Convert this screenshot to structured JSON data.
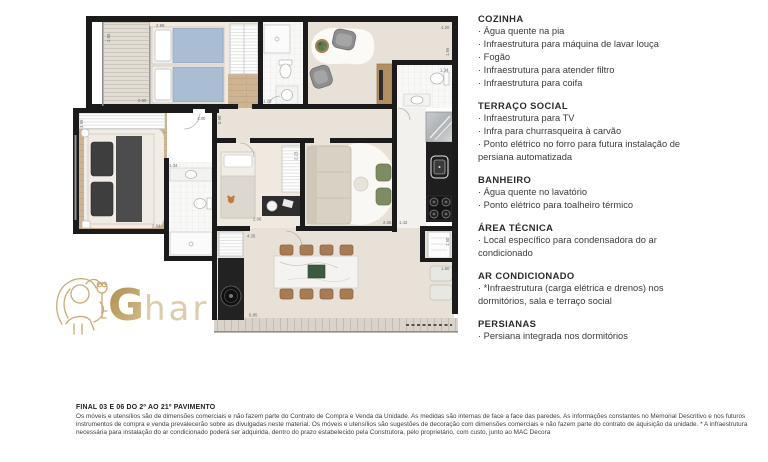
{
  "logo": {
    "initial": "G",
    "rest": "har"
  },
  "floorplan": {
    "dimensions": [
      "2.95",
      "2.99",
      "0.90",
      "4.00",
      "1.29",
      "4.20",
      "1.55",
      "1.34",
      "3.95",
      "1.34",
      "2.64",
      "2.23",
      "2.06",
      "4.35",
      "2.56",
      "1.42",
      "1.50",
      "1.80",
      "6.85",
      "0.90"
    ]
  },
  "specs": {
    "sections": [
      {
        "title": "COZINHA",
        "items": [
          "· Água quente na pia",
          "· Infraestrutura para máquina de lavar louça",
          "· Fogão",
          "· Infraestrutura para atender filtro",
          "· Infraestrutura para coifa"
        ]
      },
      {
        "title": "TERRAÇO SOCIAL",
        "items": [
          "· Infraestrutura para TV",
          "· Infra para churrasqueira à carvão",
          "· Ponto elétrico no forro para futura instalação de persiana automatizada"
        ]
      },
      {
        "title": "BANHEIRO",
        "items": [
          "· Água quente no lavatório",
          "· Ponto elétrico para toalheiro térmico"
        ]
      },
      {
        "title": "ÁREA TÉCNICA",
        "items": [
          "· Local específico para condensadora do ar condicionado"
        ]
      },
      {
        "title": "AR CONDICIONADO",
        "items": [
          "· *Infraestrutura (carga elétrica e drenos) nos dormitórios, sala e terraço social"
        ]
      },
      {
        "title": "PERSIANAS",
        "items": [
          "· Persiana integrada nos dormitórios"
        ]
      }
    ]
  },
  "footer": {
    "title": "FINAL 03 E 06 DO 2º AO 21º PAVIMENTO",
    "body": "Os móveis e utensílios são de dimensões comerciais e não fazem parte do Contrato de Compra e Venda da Unidade. As medidas são internas de face a face das paredes. As informações constantes no Memorial Descritivo e nos futuros instrumentos de compra e venda prevalecerão sobre as divulgadas neste material. Os móveis e utensílios são sugestões de decoração com dimensões comerciais e não fazem parte do contrato de aquisição da unidade. * A infraestrutura necessária para instalação do ar condicionado poderá ser adquirida, dentro do prazo estabelecido pela Construtora, pelo proprietário, com custo, junto ao MAC Decora"
  }
}
